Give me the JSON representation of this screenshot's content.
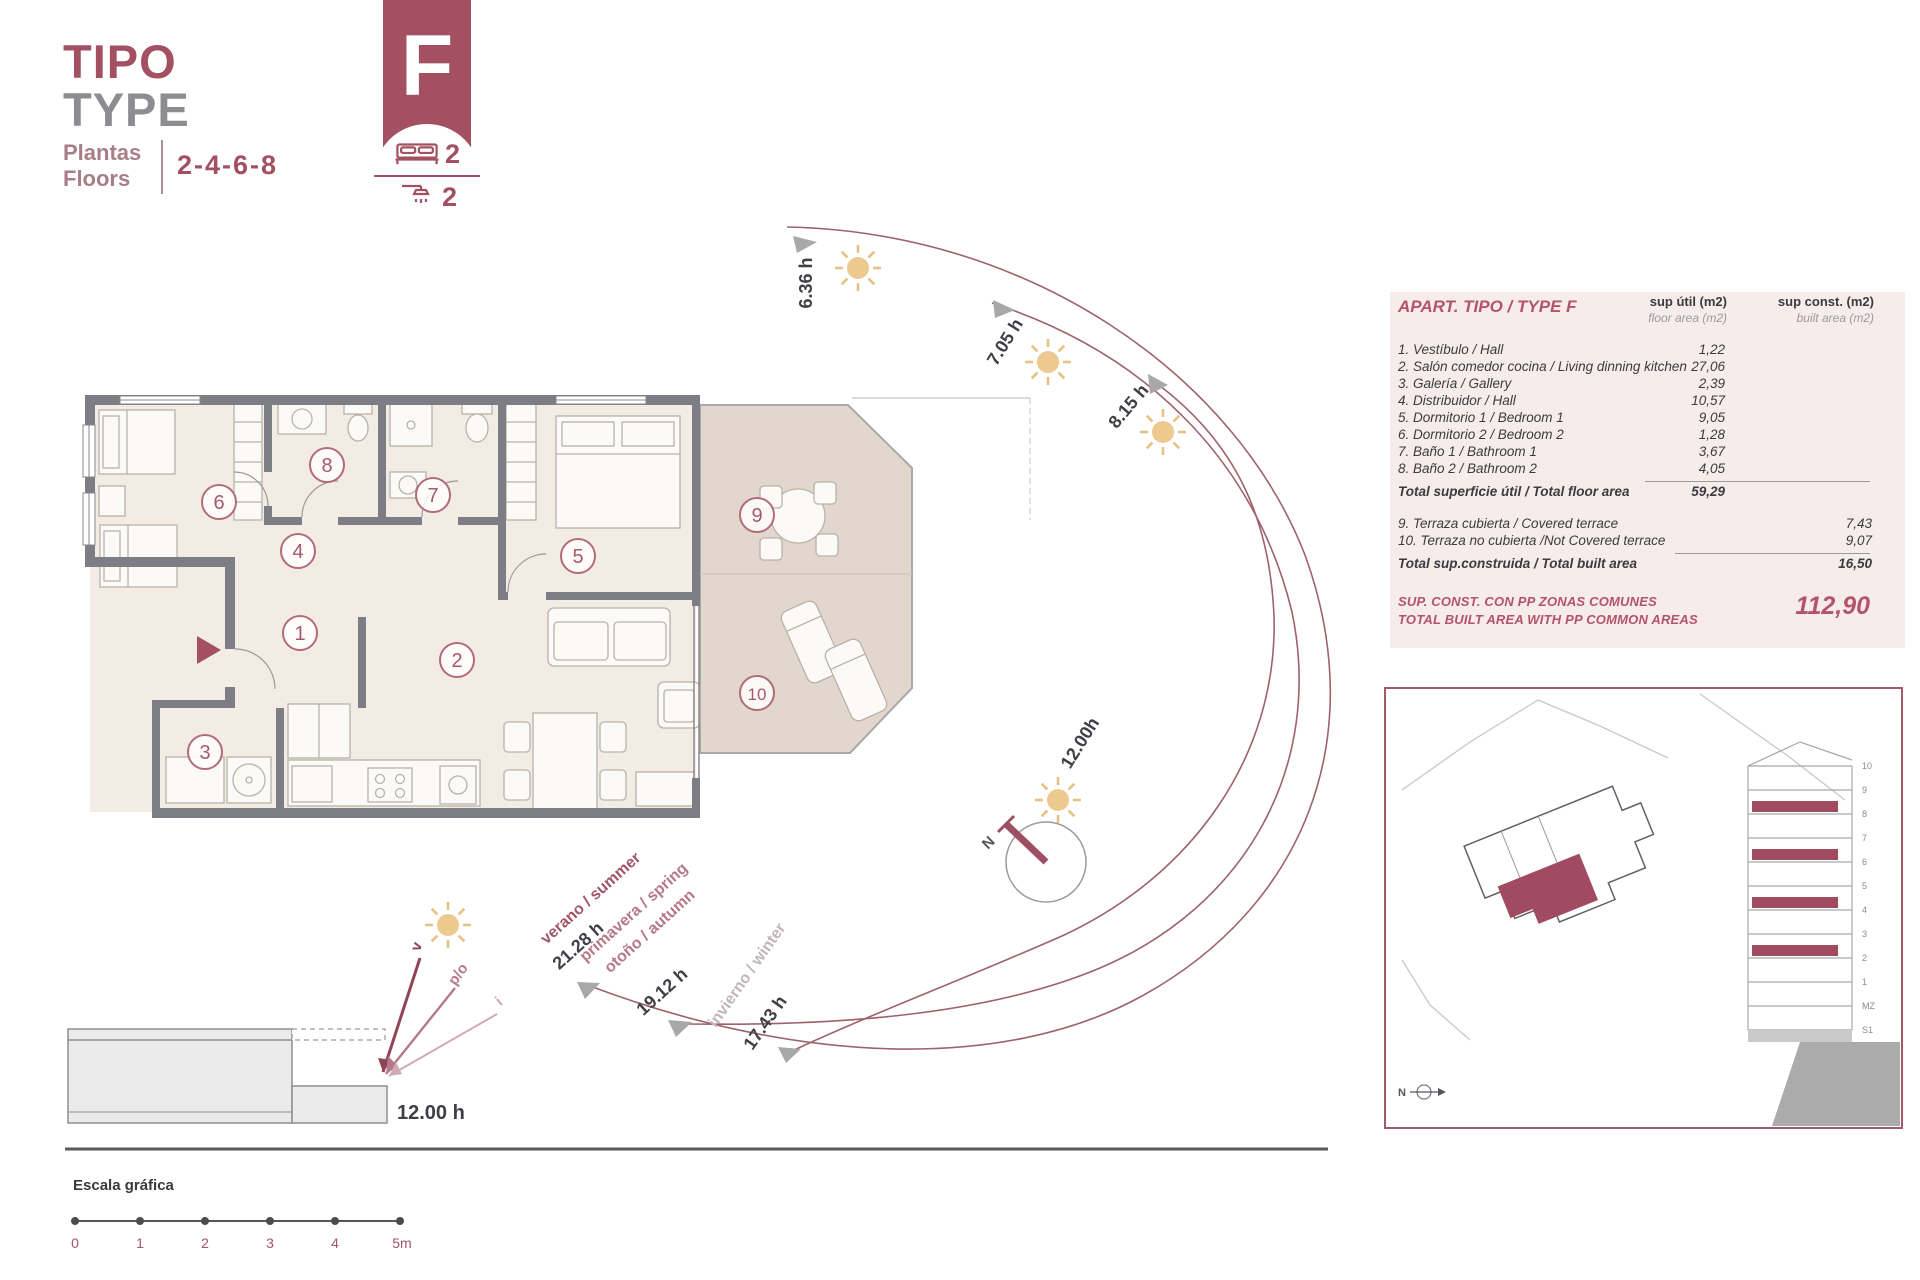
{
  "header": {
    "title_primary": "TIPO",
    "title_secondary": "TYPE",
    "floors_label_primary": "Plantas",
    "floors_label_secondary": "Floors",
    "floors_value": "2-4-6-8",
    "type_letter": "F",
    "bedrooms_count": "2",
    "bathrooms_count": "2"
  },
  "plan": {
    "room_numbers": [
      "1",
      "2",
      "3",
      "4",
      "5",
      "6",
      "7",
      "8",
      "9",
      "10"
    ]
  },
  "sun_path": {
    "sunrise_hours": [
      "6.36 h",
      "7.05 h",
      "8.15 h"
    ],
    "noon_label": "12.00h",
    "seasons": [
      {
        "name": "verano / summer",
        "sunset": "21.28 h"
      },
      {
        "name_line1": "primavera / spring",
        "name_line2": "otoño / autumn",
        "sunset": "19.12 h"
      },
      {
        "name": "invierno / winter",
        "sunset": "17.43 h"
      }
    ]
  },
  "section_diagram": {
    "noon_label": "12.00 h",
    "arrow_labels": [
      "v",
      "p/o",
      "i"
    ]
  },
  "scale_bar": {
    "title": "Escala gráfica",
    "ticks": [
      "0",
      "1",
      "2",
      "3",
      "4",
      "5m"
    ]
  },
  "area_table": {
    "title": "APART. TIPO / TYPE F",
    "col_util": {
      "line1": "sup útil (m2)",
      "line2": "floor area (m2)"
    },
    "col_const": {
      "line1": "sup const. (m2)",
      "line2": "built area (m2)"
    },
    "rows": [
      {
        "label": "1. Vestíbulo / Hall",
        "util": "1,22"
      },
      {
        "label": "2. Salón comedor cocina / Living dinning kitchen",
        "util": "27,06"
      },
      {
        "label": "3. Galería / Gallery",
        "util": "2,39"
      },
      {
        "label": "4. Distribuidor / Hall",
        "util": "10,57"
      },
      {
        "label": "5. Dormitorio 1 / Bedroom 1",
        "util": "9,05"
      },
      {
        "label": "6. Dormitorio 2 / Bedroom 2",
        "util": "1,28"
      },
      {
        "label": "7. Baño 1 / Bathroom 1",
        "util": "3,67"
      },
      {
        "label": "8. Baño 2 / Bathroom 2",
        "util": "4,05"
      }
    ],
    "total_util": {
      "label": "Total superficie útil / Total floor area",
      "value": "59,29"
    },
    "terrace_rows": [
      {
        "label": "9. Terraza cubierta / Covered terrace",
        "value": "7,43"
      },
      {
        "label": "10. Terraza no cubierta /Not Covered terrace",
        "value": "9,07"
      }
    ],
    "total_built": {
      "label": "Total sup.construida / Total built area",
      "value": "16,50"
    },
    "footer": {
      "line1": "SUP. CONST. CON PP ZONAS COMUNES",
      "line2": "TOTAL BUILT AREA WITH PP COMMON AREAS",
      "value": "112,90"
    }
  },
  "site_plan": {
    "floor_labels": [
      "10",
      "9",
      "8",
      "7",
      "6",
      "5",
      "4",
      "3",
      "2",
      "1",
      "MZ",
      "S1"
    ],
    "north_label": "N"
  },
  "compass": {
    "north_label": "N"
  },
  "colors": {
    "brand_maroon": "#a35062",
    "table_maroon": "#b4546b",
    "table_background": "#f6ece9",
    "wall_gray": "#7d7d86",
    "floor_fill": "#f3ece5",
    "terrace_fill": "#e1d7cd",
    "sun_yellow": "#ebc98f",
    "arc_maroon": "#9d626e"
  }
}
